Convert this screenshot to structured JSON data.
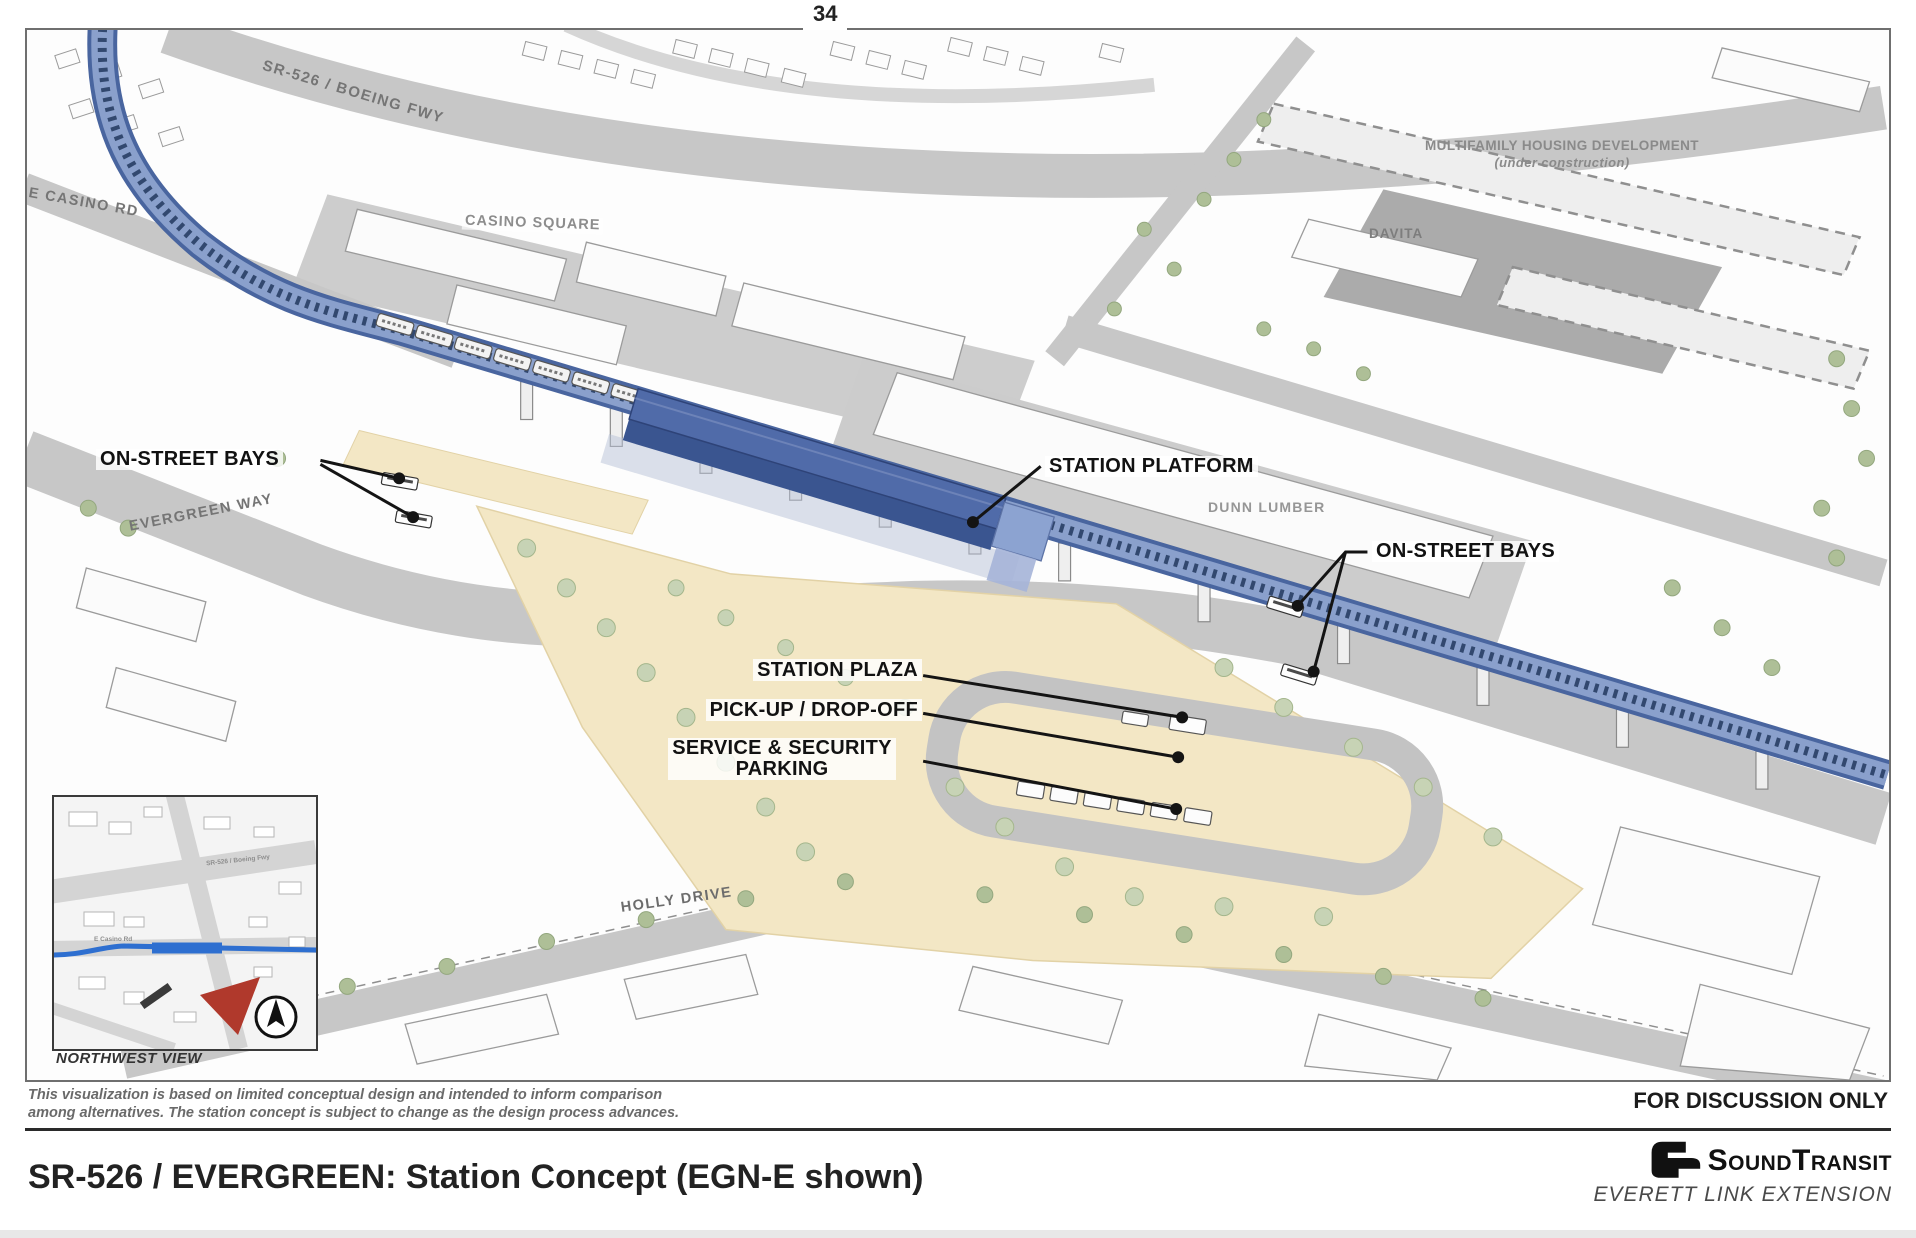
{
  "slide": {
    "page_number": "34"
  },
  "map": {
    "road_labels": {
      "boeing_fwy": "SR-526 / BOEING FWY",
      "e_casino_rd": "E CASINO RD",
      "evergreen_way": "EVERGREEN WAY",
      "holly_drive": "HOLLY DRIVE"
    },
    "place_labels": {
      "casino_square": "CASINO SQUARE",
      "multifamily_line1": "MULTIFAMILY HOUSING DEVELOPMENT",
      "multifamily_line2": "(under construction)",
      "davita": "DAVITA",
      "dunn_lumber": "DUNN LUMBER"
    },
    "callouts": {
      "on_street_bays_left": "ON-STREET BAYS",
      "station_platform": "STATION PLATFORM",
      "on_street_bays_right": "ON-STREET BAYS",
      "station_plaza": "STATION PLAZA",
      "pick_up_drop_off": "PICK-UP / DROP-OFF",
      "service_security_line1": "SERVICE & SECURITY",
      "service_security_line2": "PARKING"
    },
    "inset": {
      "caption": "NORTHWEST VIEW",
      "label_freeway": "SR-526 / Boeing Fwy",
      "label_casino": "E Casino Rd"
    }
  },
  "footer": {
    "disclaimer_line1": "This visualization is based on limited conceptual design and intended to inform comparison",
    "disclaimer_line2": "among alternatives. The station concept is subject to change as the design process advances.",
    "discussion_note": "FOR DISCUSSION ONLY",
    "title": "SR-526 / EVERGREEN: Station Concept (EGN-E shown)",
    "logo_text": "SoundTransit",
    "logo_subtitle": "EVERETT LINK EXTENSION"
  },
  "colors": {
    "guideway_blue": "#49659f",
    "guideway_deck": "#8aa0cc",
    "platform_blue": "#3a5590",
    "plaza_tan": "#f3e7c5",
    "route_blue": "#2e6fd0",
    "view_arrow_red": "#b0392c"
  }
}
